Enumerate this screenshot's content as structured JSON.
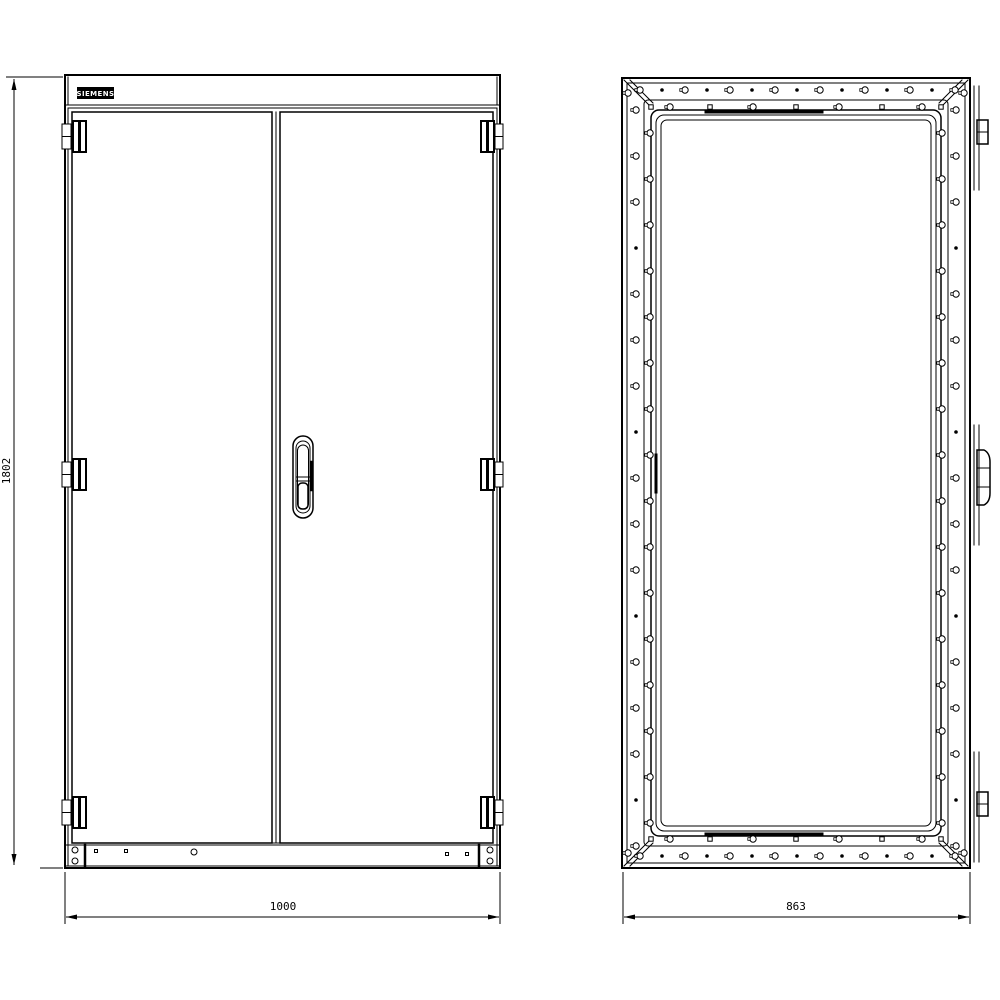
{
  "drawing": {
    "background_color": "#ffffff",
    "line_color": "#000000",
    "brand_label": "SIEMENS",
    "dimensions": {
      "height": "1802",
      "width": "1000",
      "depth": "863"
    }
  }
}
